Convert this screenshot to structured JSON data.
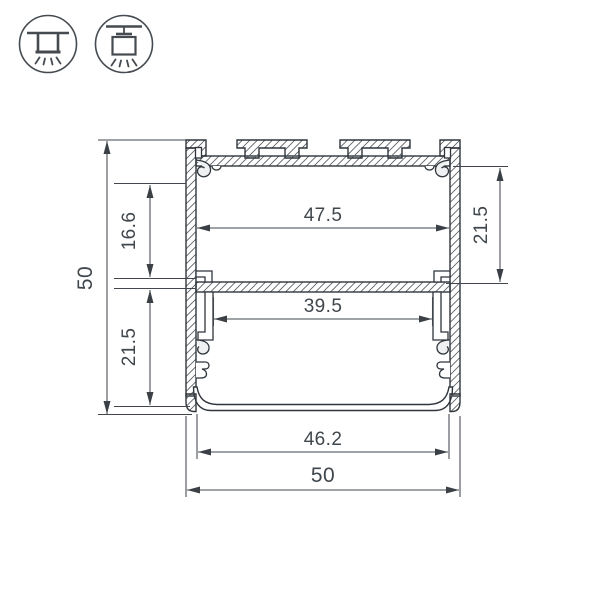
{
  "drawing": {
    "type": "technical-cross-section",
    "icons": [
      {
        "name": "surface-mount-icon"
      },
      {
        "name": "pendant-mount-icon"
      }
    ],
    "dimensions": {
      "overall_height": "50",
      "overall_width": "50",
      "upper_inner_width": "47.5",
      "middle_inner_width": "39.5",
      "diffuser_width": "46.2",
      "upper_cavity_height": "16.6",
      "lower_cavity_height": "21.5",
      "right_upper_cavity_height": "21.5"
    },
    "colors": {
      "outline": "#2f353b",
      "dimension_line": "#41474d",
      "text": "#3f464c",
      "hatch": "#596066",
      "light_fill": "#eef0f1",
      "background": "#ffffff"
    }
  }
}
